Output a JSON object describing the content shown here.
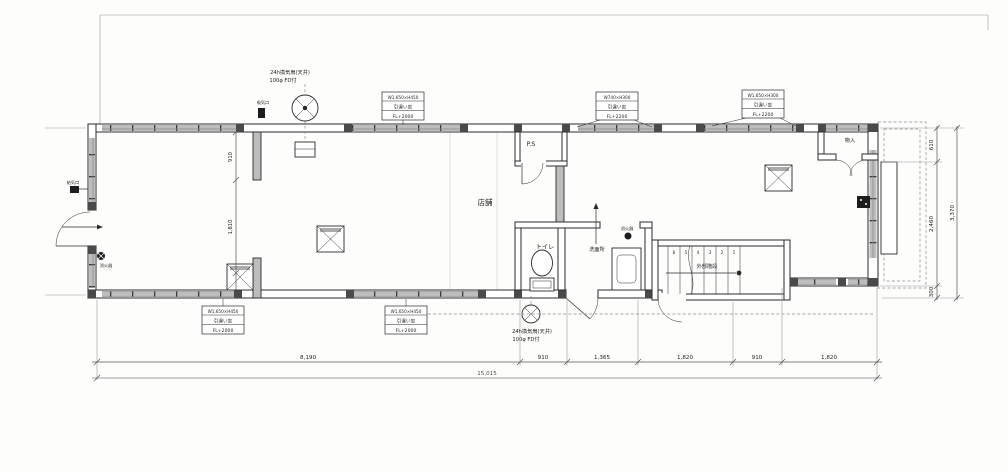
{
  "plan": {
    "rooms": {
      "shop": "店舗",
      "toilet": "トイレ",
      "washroom": "洗面所",
      "pipe_space": "P.S",
      "closet": "物入",
      "stairs": "外部階段"
    },
    "notes": {
      "fan_top_line1": "24h換気扇(天井)",
      "fan_top_line2": "100φ FD付",
      "fan_bottom_line1": "24h換気扇(天井)",
      "fan_bottom_line2": "100φ FD付",
      "extinguisher_left": "消火器",
      "extinguisher_washroom": "消火器",
      "supply_vent": "給気口",
      "intake_vent": "吸気口"
    },
    "window_labels": {
      "top_center": {
        "l1": "W1,650×H450",
        "l2": "引違い窓",
        "l3": "FL+2000"
      },
      "top_mid": {
        "l1": "W740×H300",
        "l2": "引違い窓",
        "l3": "FL+2200"
      },
      "top_right": {
        "l1": "W1,650×H300",
        "l2": "引違い窓",
        "l3": "FL+2200"
      },
      "bottom_left": {
        "l1": "W1,650×H450",
        "l2": "引違い窓",
        "l3": "FL+2000"
      },
      "bottom_center": {
        "l1": "W1,650×H450",
        "l2": "引違い窓",
        "l3": "FL+2000"
      }
    },
    "stair_steps": [
      "6",
      "5",
      "4",
      "3",
      "2",
      "1"
    ],
    "dimensions": {
      "bottom": [
        "8,190",
        "910",
        "1,365",
        "1,820",
        "910",
        "1,820"
      ],
      "bottom_total": "15,015",
      "right": [
        "610",
        "2,460",
        "300"
      ],
      "right_total": "3,370",
      "interior_top": "910",
      "interior_bottom": "1,810"
    },
    "colors": {
      "line": "#2b2b2b",
      "wall_window_fill": "#bdbdbd",
      "background": "#fdfdfc"
    }
  }
}
